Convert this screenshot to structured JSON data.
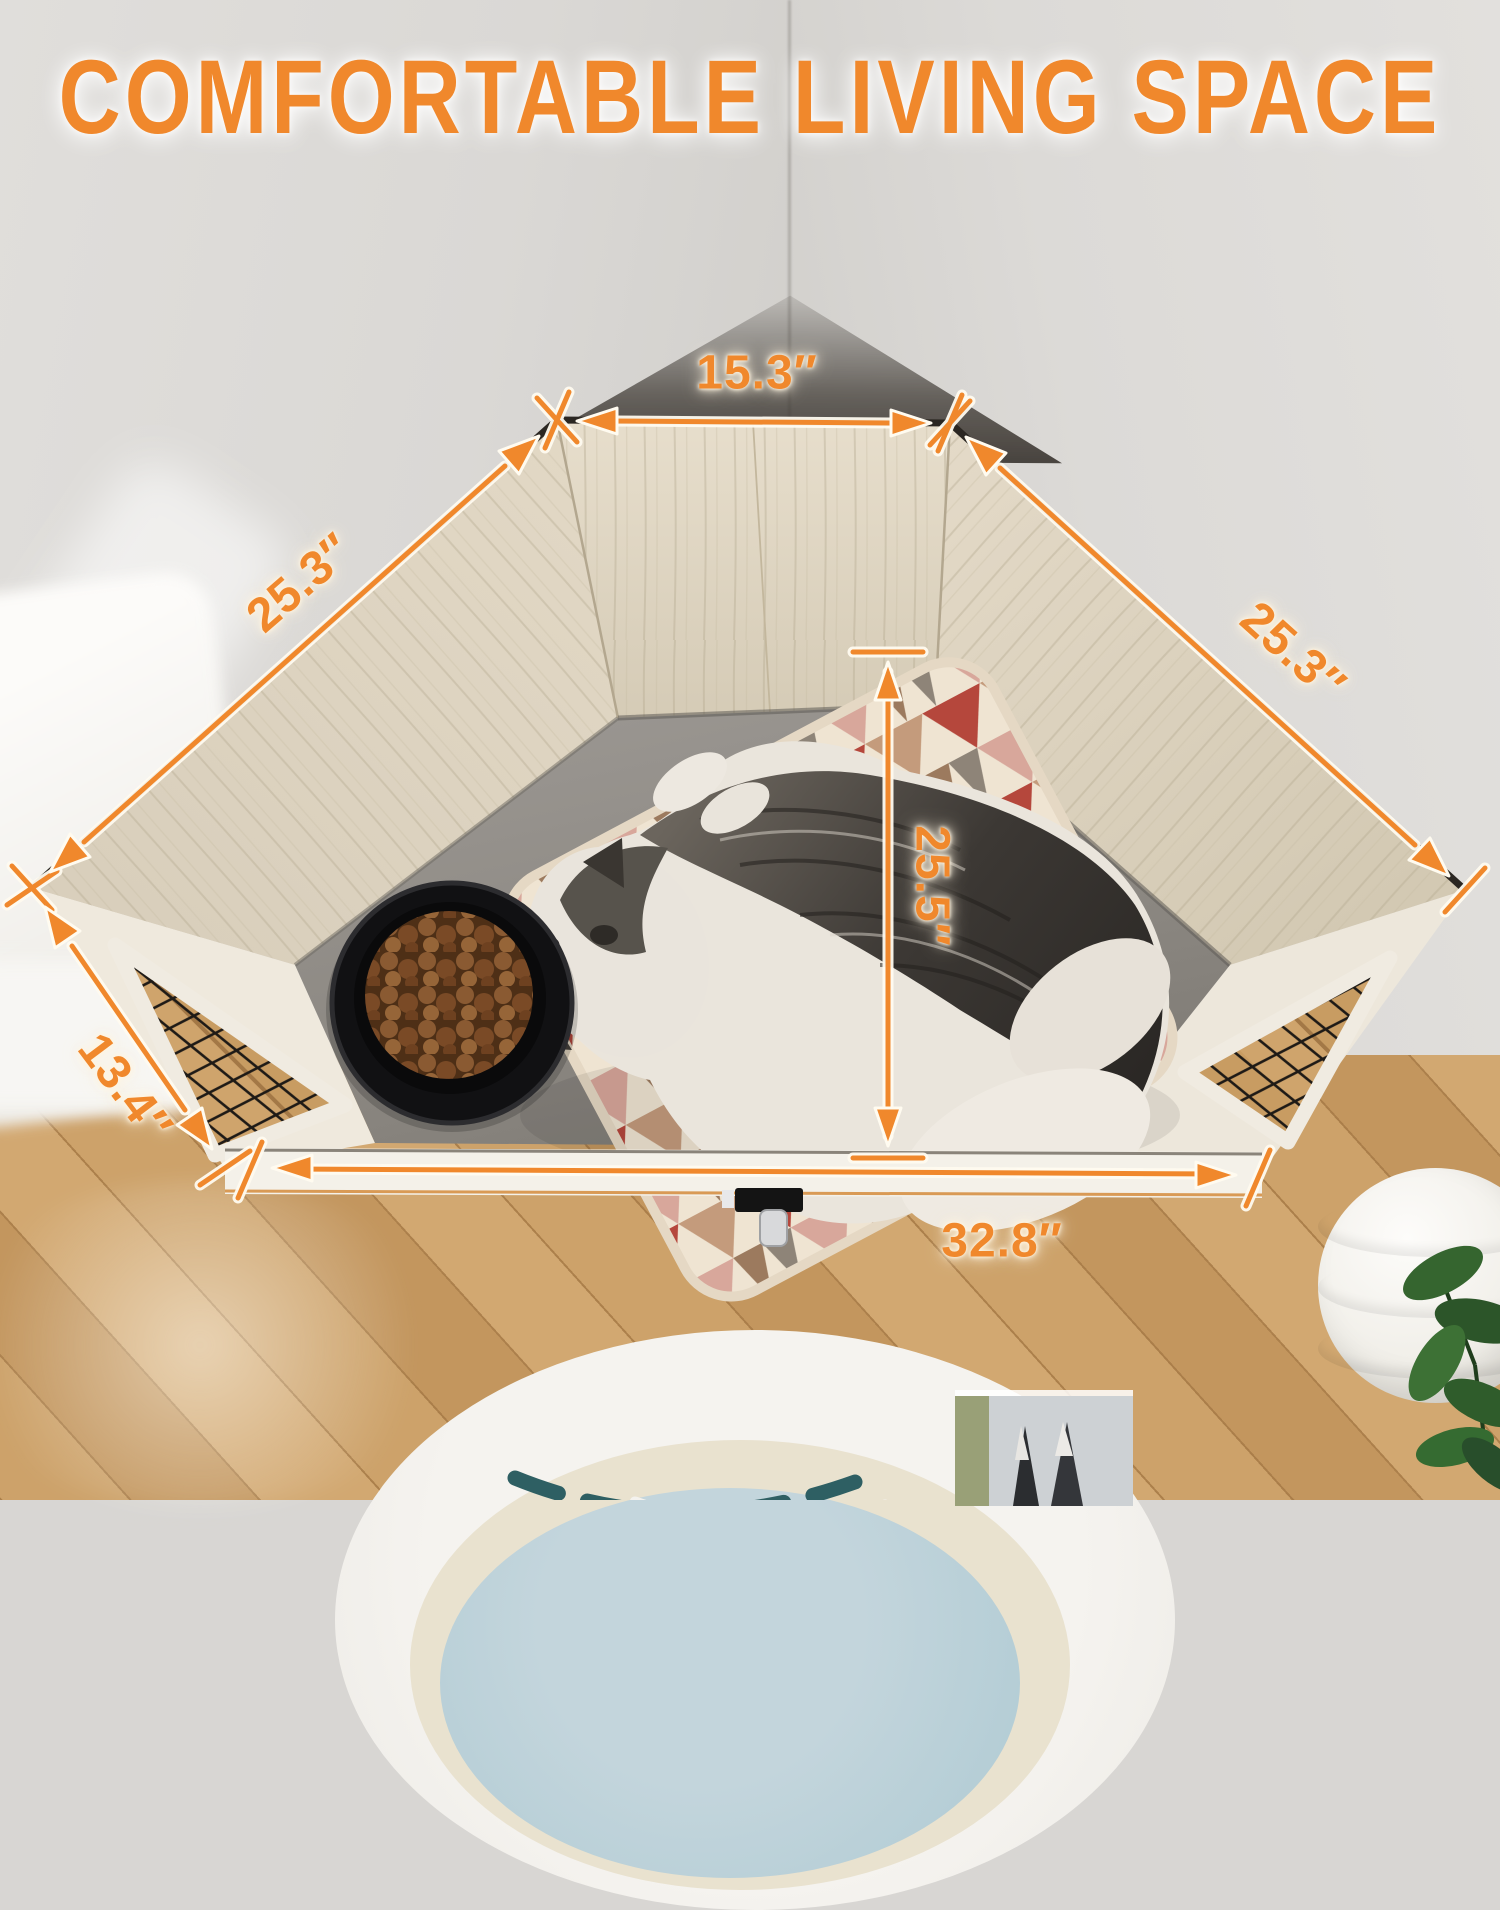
{
  "title": "COMFORTABLE LIVING SPACE",
  "accent_color": "#F0882C",
  "glow_color": "#FFF4E0",
  "dimensions": {
    "back_width": "15.3″",
    "left_side": "25.3″",
    "right_side": "25.3″",
    "inner_depth": "25.5″",
    "front_left_side": "13.4″",
    "front_width": "32.8″"
  }
}
